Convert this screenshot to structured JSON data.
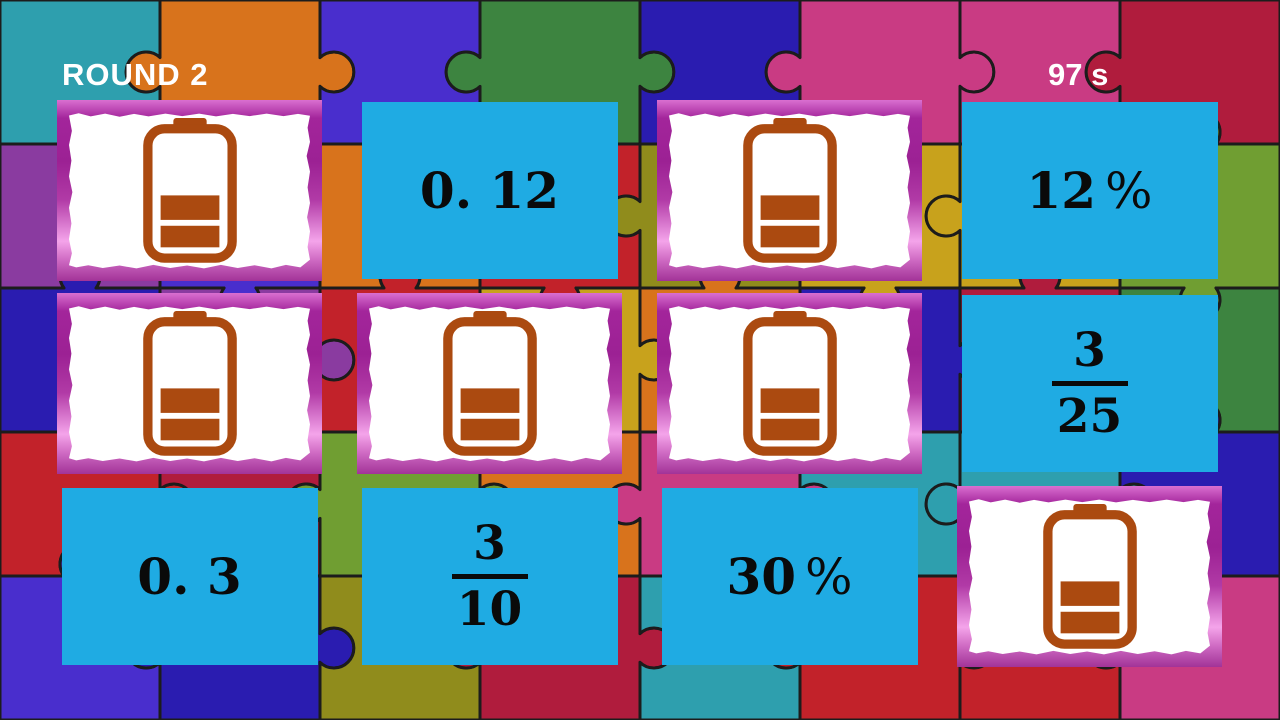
{
  "hud": {
    "round_label": "ROUND 2",
    "timer": "97 s"
  },
  "colors": {
    "card_face": "#1fabe3",
    "card_text": "#0a0a0a",
    "battery_orange": "#ab4a10",
    "frame_magenta": "#b13aa6",
    "hud_text": "#ffffff"
  },
  "cards": [
    {
      "id": "r1c1",
      "type": "back",
      "icon": "battery-icon"
    },
    {
      "id": "r1c2",
      "type": "decimal",
      "label": "0. 12"
    },
    {
      "id": "r1c3",
      "type": "back",
      "icon": "battery-icon"
    },
    {
      "id": "r1c4",
      "type": "percent",
      "value": "12",
      "unit": "%"
    },
    {
      "id": "r2c1",
      "type": "back",
      "icon": "battery-icon"
    },
    {
      "id": "r2c2",
      "type": "back",
      "icon": "battery-icon"
    },
    {
      "id": "r2c3",
      "type": "back",
      "icon": "battery-icon"
    },
    {
      "id": "r2c4",
      "type": "fraction",
      "numerator": "3",
      "denominator": "25"
    },
    {
      "id": "r3c1",
      "type": "decimal",
      "label": "0. 3"
    },
    {
      "id": "r3c2",
      "type": "fraction",
      "numerator": "3",
      "denominator": "10"
    },
    {
      "id": "r3c3",
      "type": "percent",
      "value": "30",
      "unit": "%"
    },
    {
      "id": "r3c4",
      "type": "back",
      "icon": "battery-icon"
    }
  ]
}
